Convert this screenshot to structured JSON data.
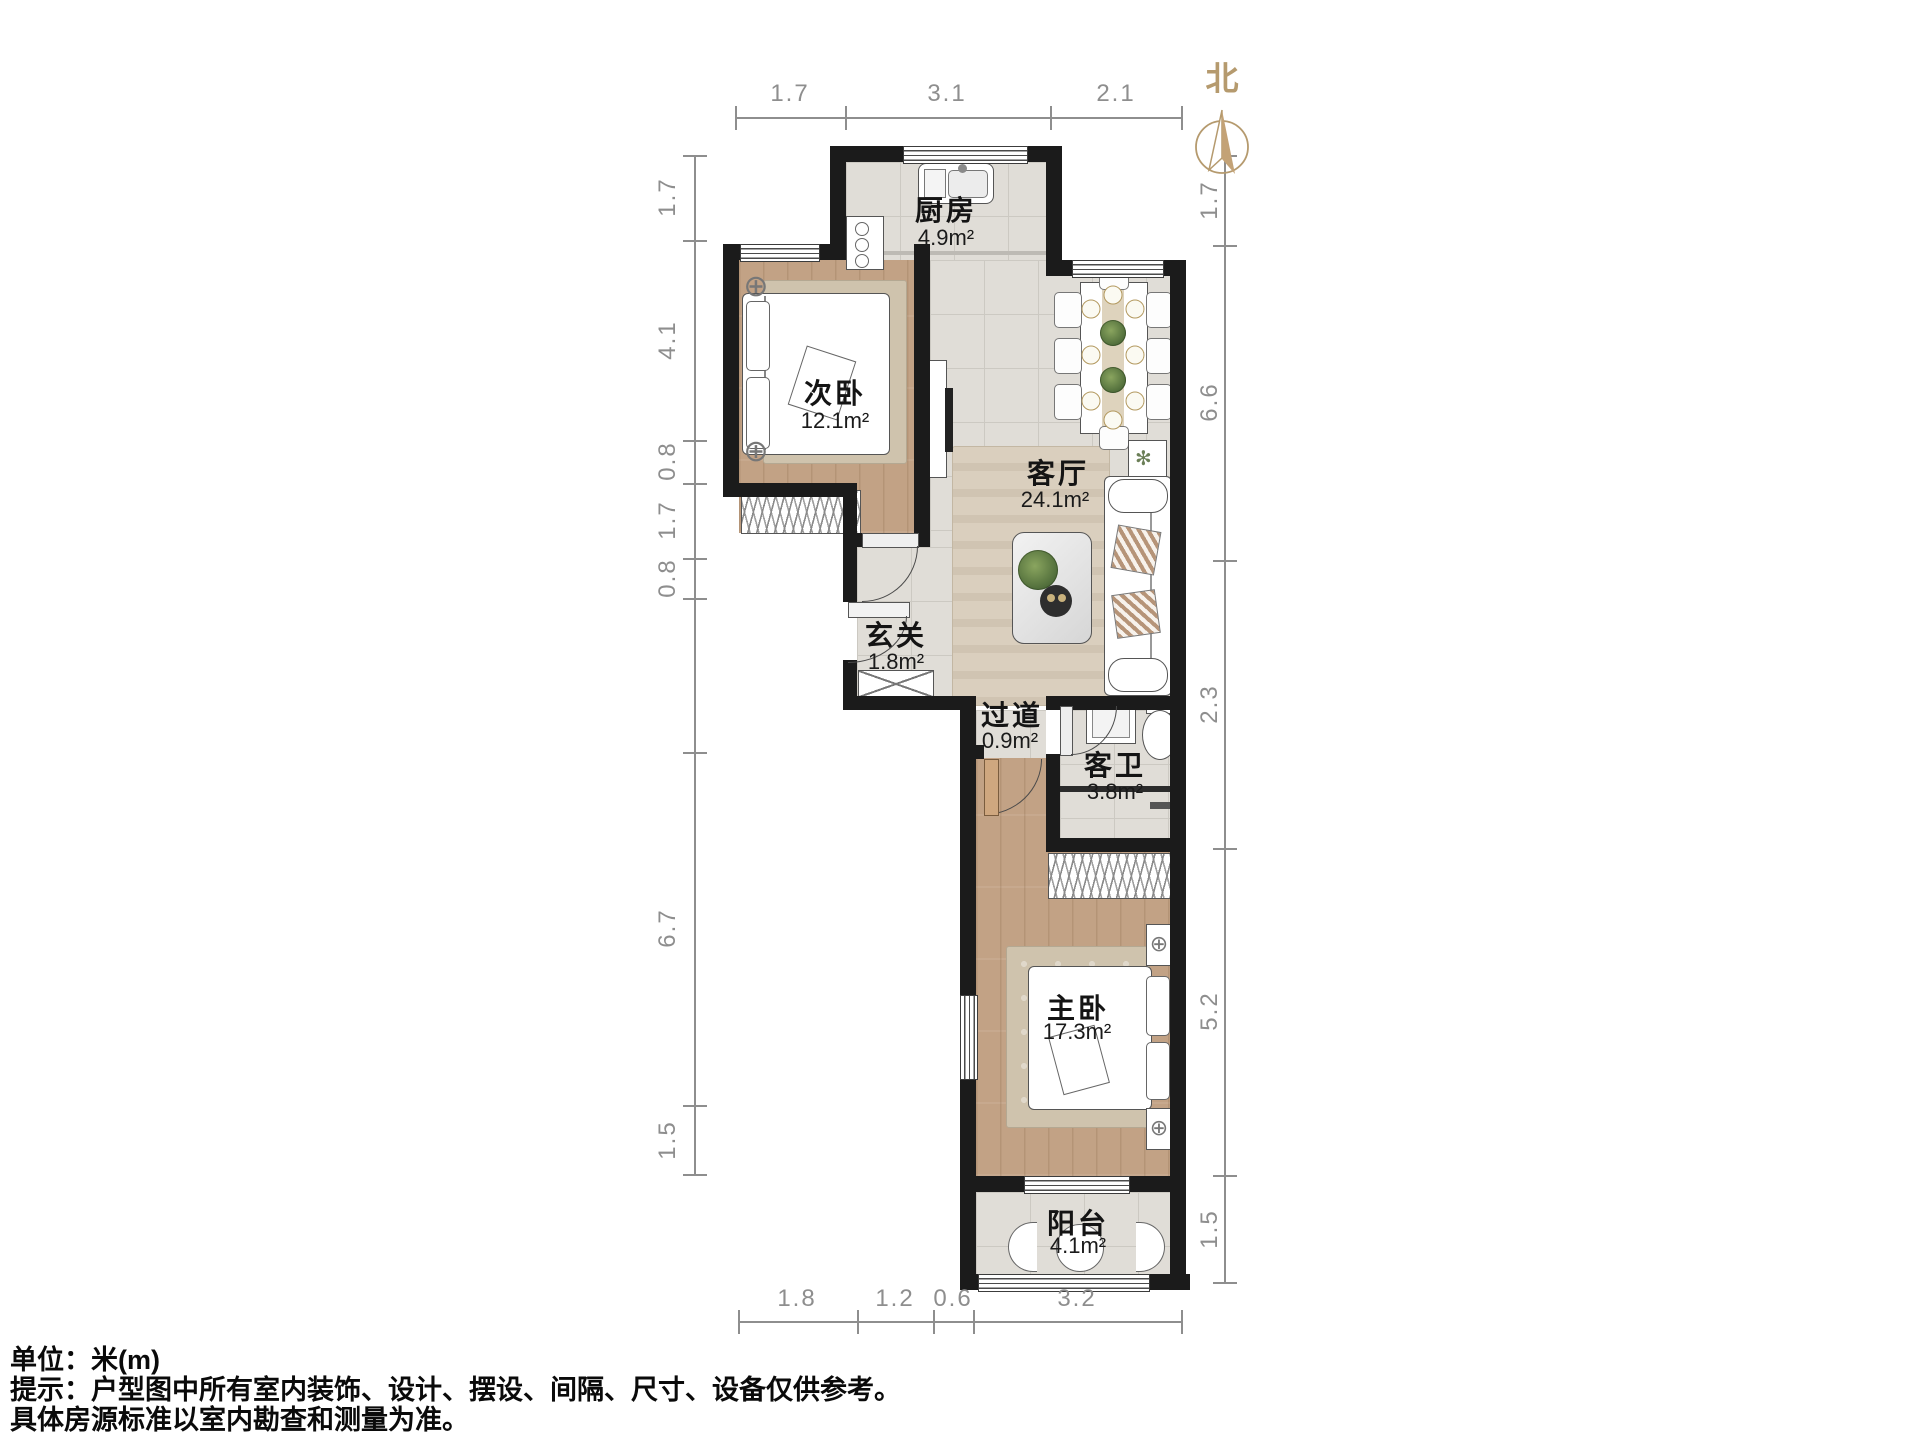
{
  "compass": {
    "label": "北"
  },
  "rooms": {
    "kitchen": {
      "name": "厨房",
      "area": "4.9m²"
    },
    "second_bedroom": {
      "name": "次卧",
      "area": "12.1m²"
    },
    "living_room": {
      "name": "客厅",
      "area": "24.1m²"
    },
    "entrance": {
      "name": "玄关",
      "area": "1.8m²"
    },
    "hallway": {
      "name": "过道",
      "area": "0.9m²"
    },
    "bathroom": {
      "name": "客卫",
      "area": "3.8m²"
    },
    "master_bedroom": {
      "name": "主卧",
      "area": "17.3m²"
    },
    "balcony": {
      "name": "阳台",
      "area": "4.1m²"
    }
  },
  "dimensions": {
    "top": [
      "1.7",
      "3.1",
      "2.1"
    ],
    "left": [
      "1.7",
      "4.1",
      "0.8",
      "1.7",
      "0.8",
      "6.7",
      "1.5"
    ],
    "right": [
      "1.7",
      "6.6",
      "2.3",
      "5.2",
      "1.5"
    ],
    "bottom": [
      "1.8",
      "1.2",
      "0.6",
      "3.2"
    ]
  },
  "footer": {
    "line1": "单位：米(m)",
    "line2": "提示：户型图中所有室内装饰、设计、摆设、间隔、尺寸、设备仅供参考。",
    "line3": "具体房源标准以室内勘查和测量为准。"
  },
  "symbols": {
    "ceiling_fixture": "⊕",
    "plant_glyph": "✻"
  },
  "colors": {
    "wall": "#1b1b1b",
    "wood_floor": "#c2a285",
    "tile_floor": "#e0ddd7",
    "compass_accent": "#b59a6e",
    "dimension_gray": "#8e8e8e"
  }
}
